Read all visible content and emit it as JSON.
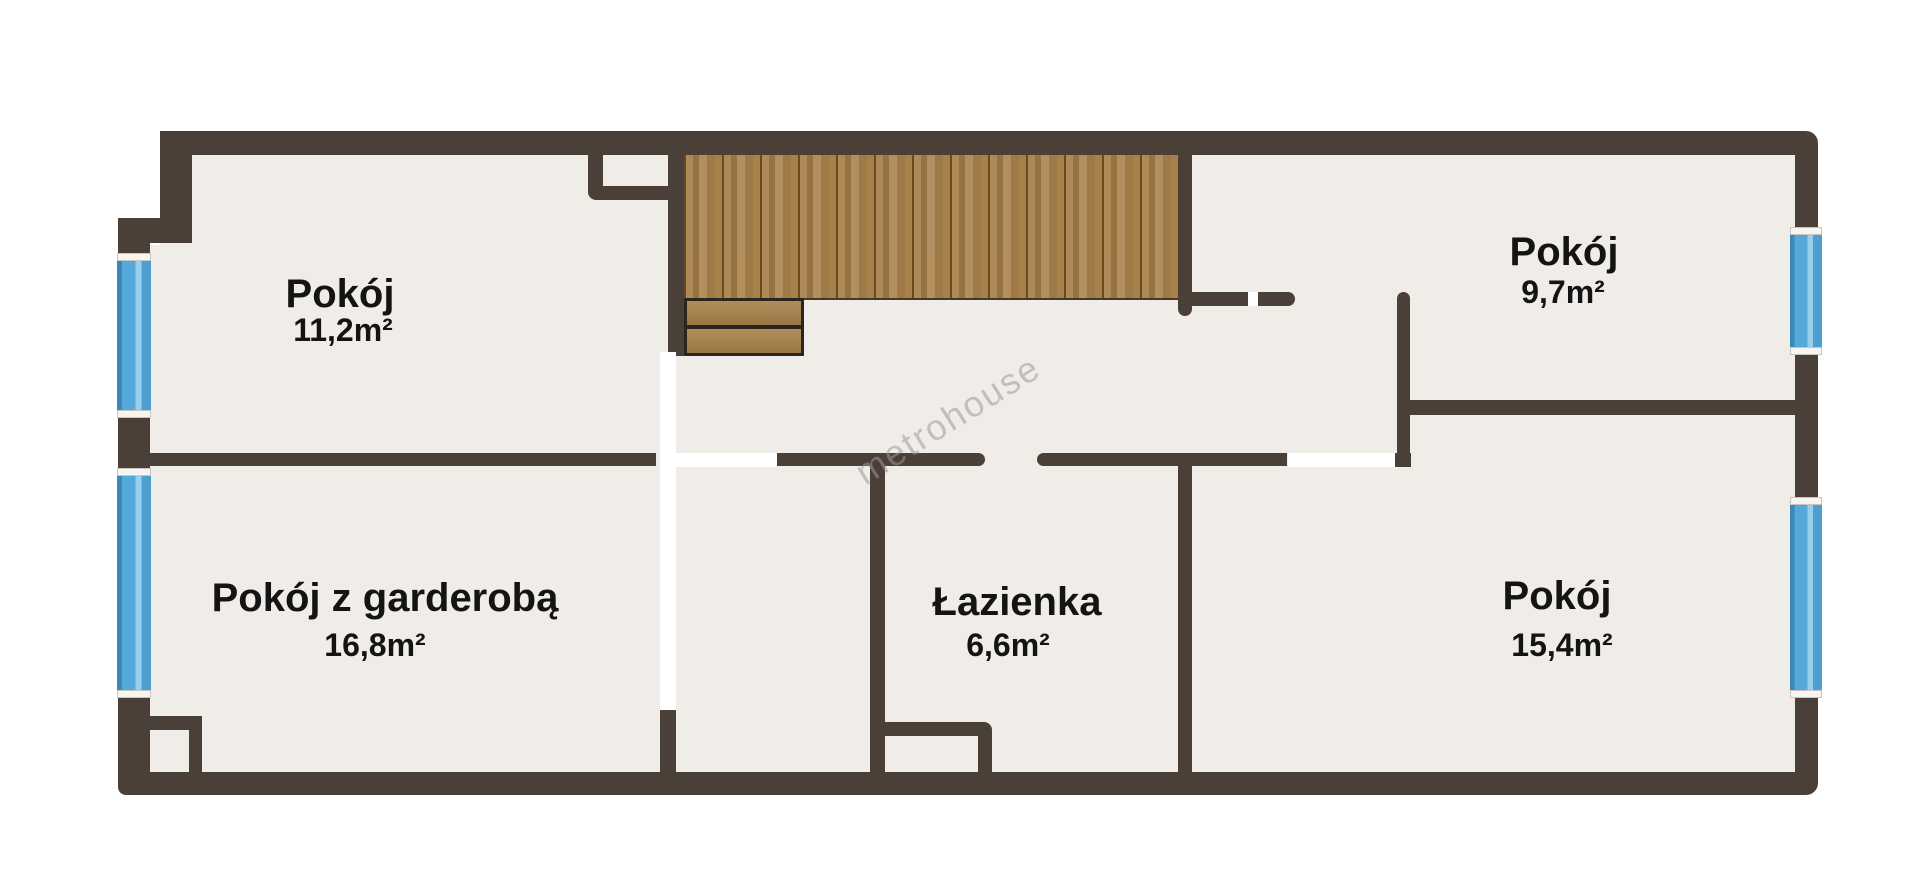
{
  "watermark": "metrohouse",
  "rooms": [
    {
      "name": "Pokój",
      "area": "11,2m²"
    },
    {
      "name": "Pokój",
      "area": "9,7m²"
    },
    {
      "name": "Pokój z garderobą",
      "area": "16,8m²"
    },
    {
      "name": "Łazienka",
      "area": "6,6m²"
    },
    {
      "name": "Pokój",
      "area": "15,4m²"
    }
  ],
  "colors": {
    "wall": "#4a4038",
    "floor": "#f0ede9",
    "outside": "#ffffff",
    "window_blue": "#55a8da",
    "window_frame": "#f7f5f2",
    "stair_wood": "#a8804a",
    "landing_outline": "#2b261c",
    "label_text": "#141414",
    "watermark_gray": "#9a9a9a"
  }
}
